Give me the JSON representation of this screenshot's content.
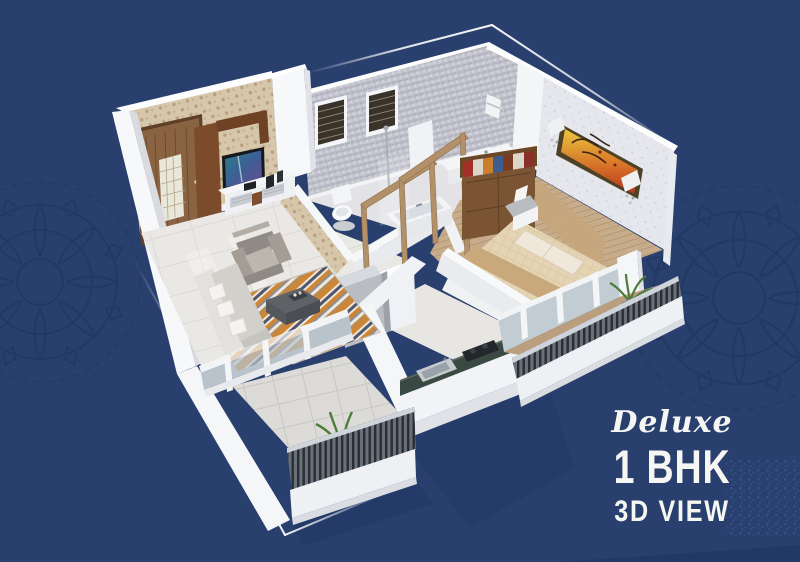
{
  "title": {
    "script": "Deluxe",
    "main": "1 BHK",
    "sub": "3D VIEW"
  },
  "colors": {
    "background": "#293f6d",
    "background_dark": "#1d3562",
    "ornament": "#1c3460",
    "frame_line": "#ffffff",
    "text": "#f6f6f3",
    "wall": "#f5f6f8",
    "wall_shade": "#dfe1e6",
    "wallpaper_living": "#d6c7ab",
    "tile_bathroom": "#c5c5cf",
    "wallpaper_bedroom": "#e6e6ed",
    "door_wood": "#8a6342",
    "tv_unit_wood": "#7b4b2b",
    "floor_tile": "#eae8e4",
    "floor_wood": "#c8ad8c",
    "kitchen_counter": "#3a4a42",
    "rug_orange": "#cf8634",
    "railing": "#3e444b",
    "plant": "#4d7c3a",
    "bed": "#c9a87e",
    "sofa": "#9c9aa0"
  }
}
